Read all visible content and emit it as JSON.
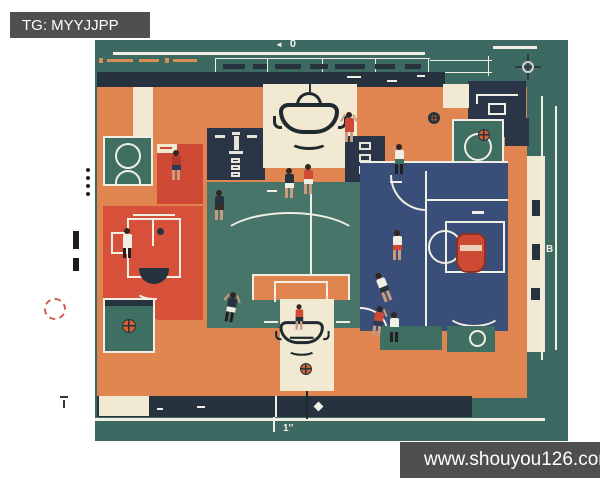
{
  "watermarks": {
    "top_left": "TG: MYYJJPP",
    "bottom_right": "www.shouyou126.com"
  },
  "blueprint_labels": {
    "top_arrow": "◄",
    "top_value": "0",
    "right_value": "B",
    "bottom_value": "1''"
  },
  "palette": {
    "background": "#ffffff",
    "canvas_teal": "#3c6a62",
    "court_orange": "#e08450",
    "court_red": "#d0492f",
    "court_navy": "#394e78",
    "panel_cream": "#f2e9d2",
    "band_navy": "#27323f",
    "line_white": "#f1efe4",
    "watermark_gray": "#4f4f4f"
  }
}
